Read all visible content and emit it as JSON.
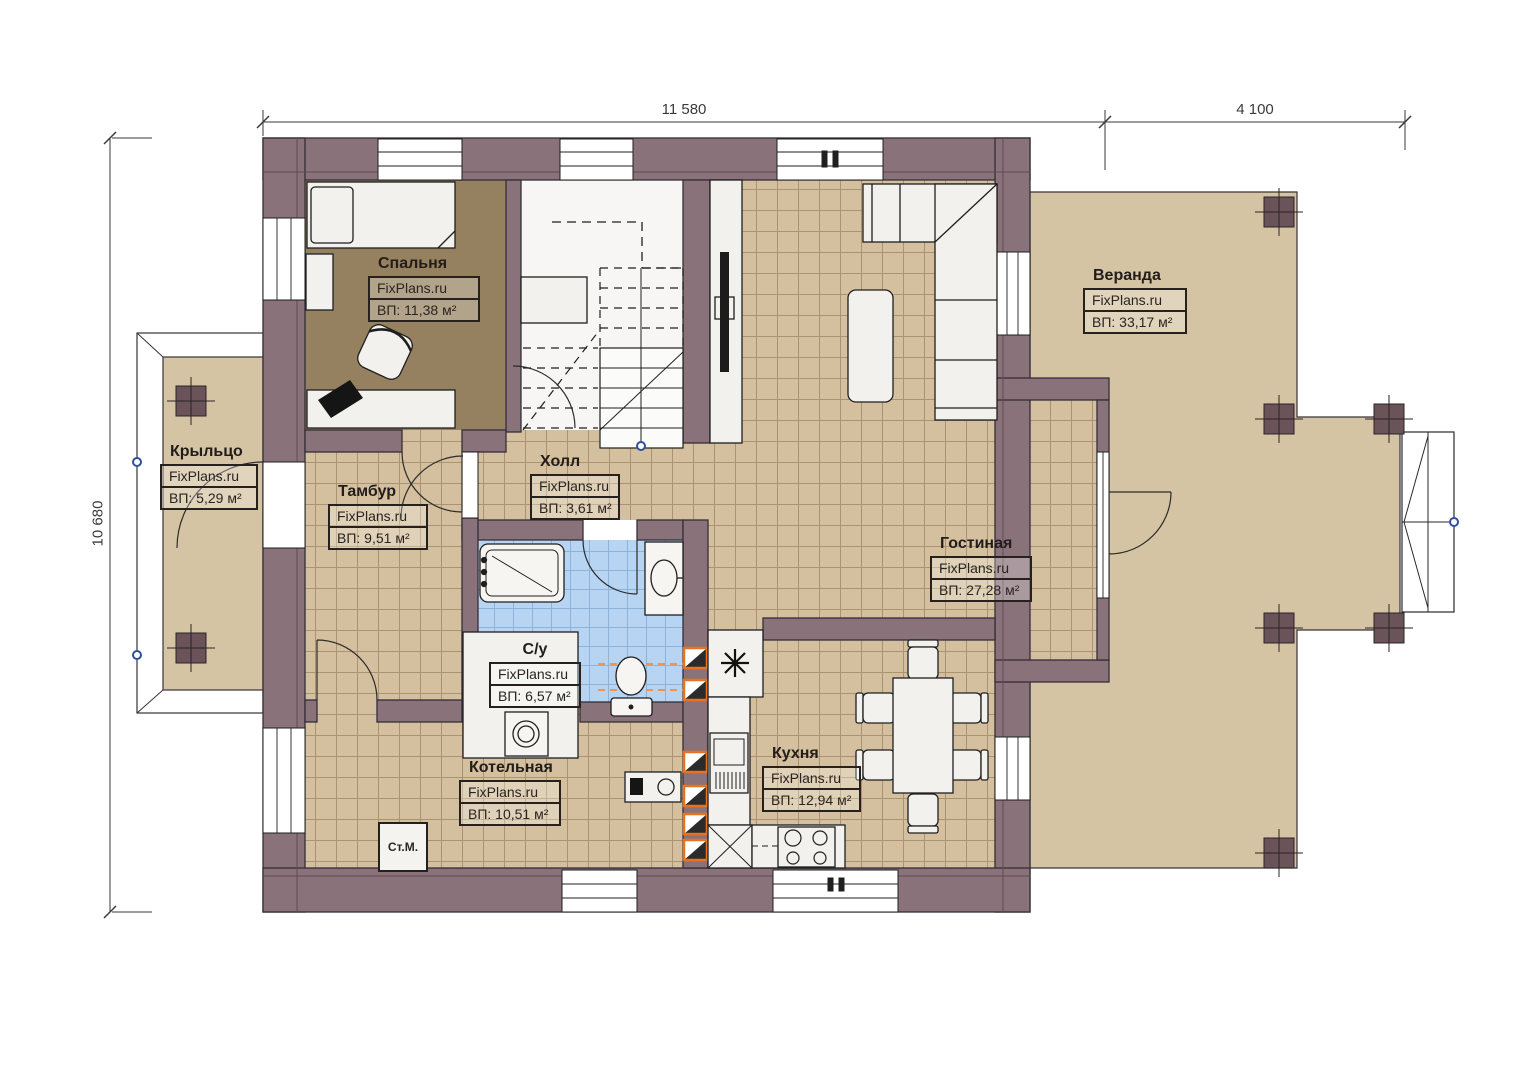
{
  "watermark": "FixPlans.ru",
  "dimensions": {
    "width_main": "11 580",
    "width_veranda": "4 100",
    "height_left": "10 680"
  },
  "rooms": [
    {
      "key": "bedroom",
      "name": "Спальня",
      "area": "ВП: 11,38 м²"
    },
    {
      "key": "veranda",
      "name": "Веранда",
      "area": "ВП: 33,17 м²"
    },
    {
      "key": "porch",
      "name": "Крыльцо",
      "area": "ВП: 5,29 м²"
    },
    {
      "key": "vestibule",
      "name": "Тамбур",
      "area": "ВП: 9,51 м²"
    },
    {
      "key": "hall",
      "name": "Холл",
      "area": "ВП: 3,61 м²"
    },
    {
      "key": "living",
      "name": "Гостиная",
      "area": "ВП: 27,28 м²"
    },
    {
      "key": "bathroom",
      "name": "С/у",
      "area": "ВП: 6,57 м²"
    },
    {
      "key": "boiler",
      "name": "Котельная",
      "area": "ВП: 10,51 м²"
    },
    {
      "key": "kitchen",
      "name": "Кухня",
      "area": "ВП: 12,94 м²"
    }
  ],
  "annotations": {
    "washing_machine": "Ст.М."
  },
  "colors": {
    "wall": "#8a727a",
    "floor_tile": "#d4bf9f",
    "bedroom_floor": "#95815f",
    "bathroom_tile": "#b7d4f2",
    "deck": "#d5c4a4",
    "vent_orange": "#e8731e",
    "node_blue": "#2f4f9e"
  }
}
